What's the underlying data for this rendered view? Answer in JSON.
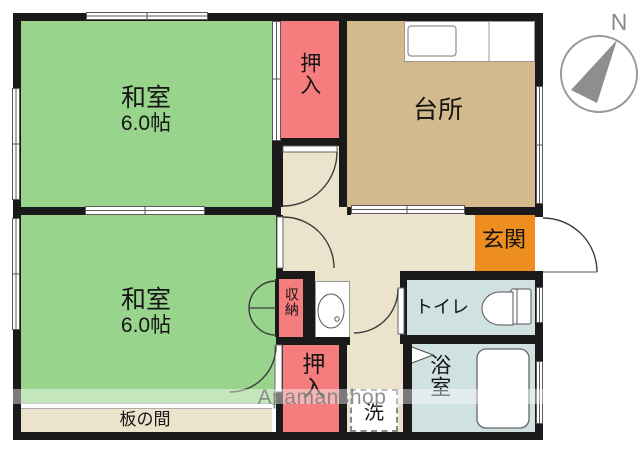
{
  "rooms": {
    "washitsu1": {
      "name": "和室",
      "size": "6.0帖"
    },
    "washitsu2": {
      "name": "和室",
      "size": "6.0帖"
    },
    "kitchen": {
      "name": "台所"
    },
    "closet_top": {
      "name": "押入"
    },
    "closet_bottom": {
      "name": "押入"
    },
    "storage": {
      "name": "収納"
    },
    "entrance": {
      "name": "玄関"
    },
    "toilet": {
      "name": "トイレ"
    },
    "bath": {
      "name": "浴室"
    },
    "washer": {
      "name": "洗"
    },
    "itanoma": {
      "name": "板の間"
    }
  },
  "compass": {
    "label": "N"
  },
  "watermark": {
    "text": "Apamanshop"
  },
  "colors": {
    "tatami_green": "#99d48c",
    "closet_pink": "#f57d7d",
    "kitchen_tan": "#d3b98c",
    "hall_beige": "#ece3cd",
    "wet_area_blue": "#cfe1e1",
    "entrance_orange": "#ee8d20",
    "wall_black": "#1a1a1a"
  }
}
